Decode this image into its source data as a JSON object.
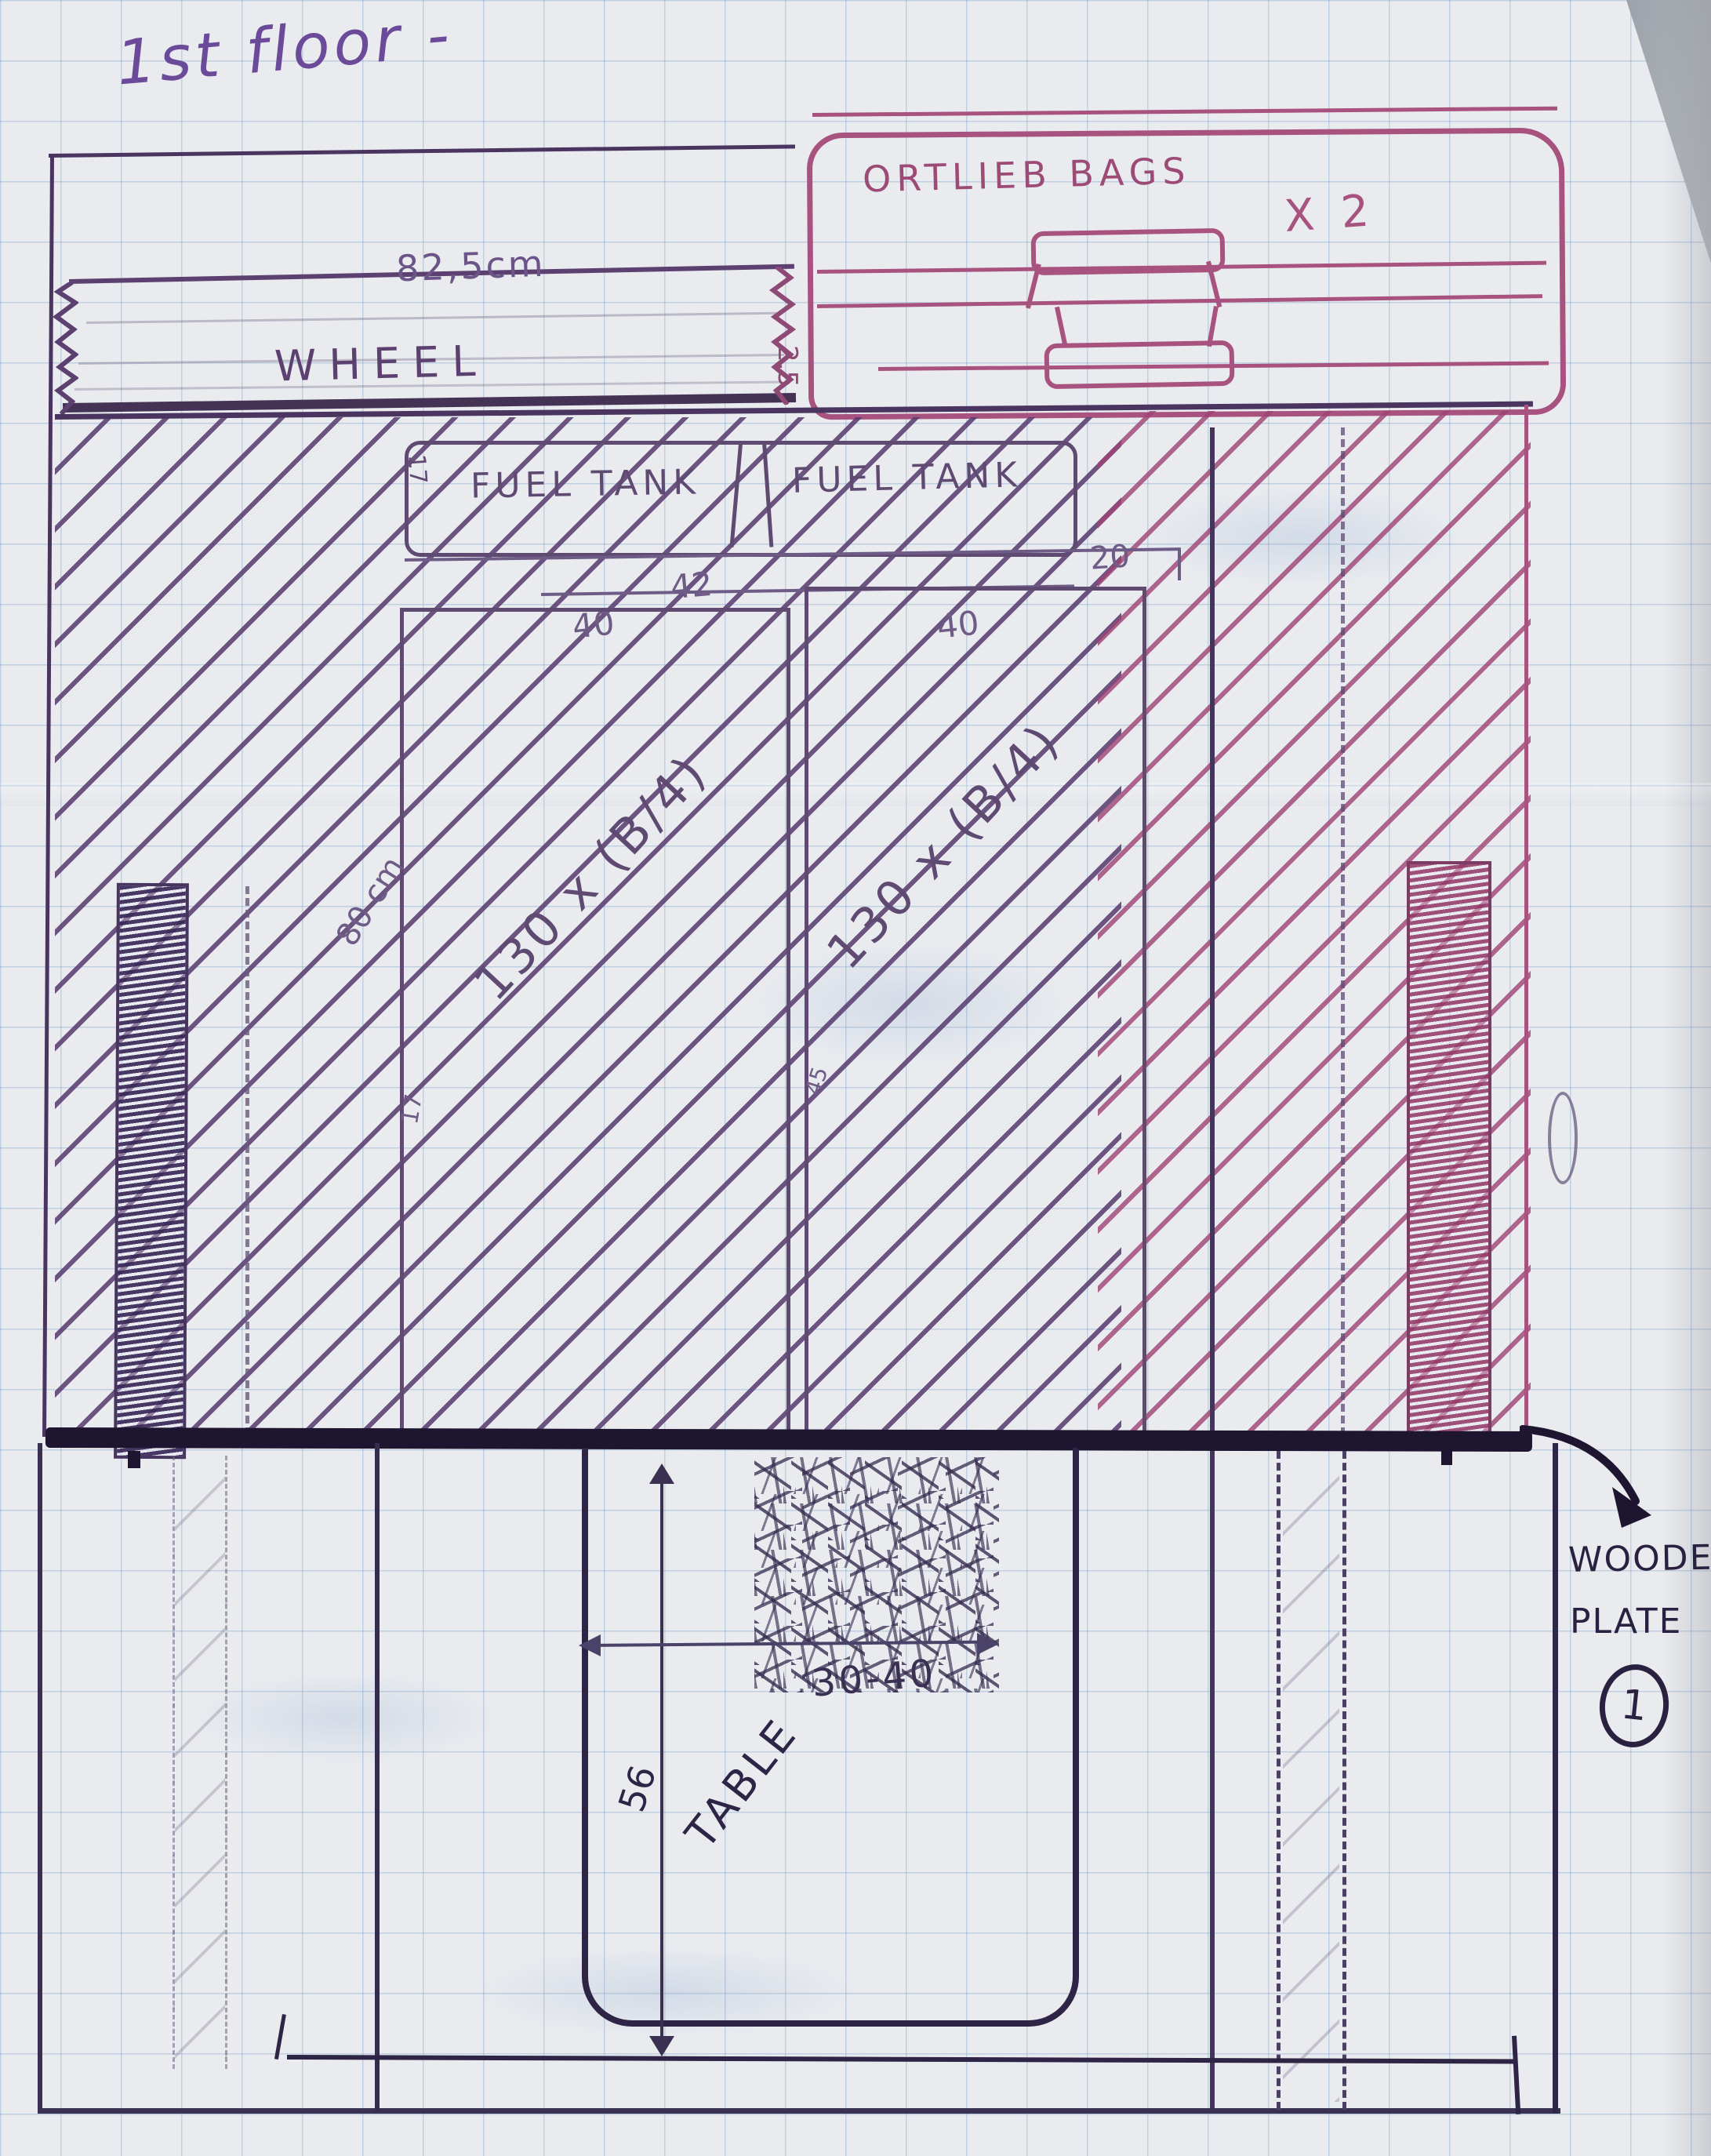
{
  "title": "1st floor -",
  "wheel": {
    "dim": "82,5cm",
    "label": "WHEEL",
    "side_dim": "2,5"
  },
  "bags": {
    "label": "ORTLIEB BAGS",
    "qty": "X 2"
  },
  "fuel": {
    "label_left": "FUEL TANK",
    "label_right": "FUEL TANK",
    "side": "17"
  },
  "dims": {
    "d42": "42",
    "d40_left": "40",
    "d40_right": "40",
    "d20": "20",
    "d80": "80 cm",
    "d17_small": "17",
    "d45_small": "45"
  },
  "beds": {
    "left_label": "130 x (B/4)",
    "right_label": "130 x (B/4)"
  },
  "table": {
    "label": "TABLE",
    "width_dim": "30-40",
    "height_dim": "56"
  },
  "plate": {
    "line1": "WOODEN",
    "line2": "PLATE",
    "number": "1"
  },
  "colors": {
    "ink_purple": "#5c4170",
    "ink_pink": "#a8537f",
    "pencil_dark": "#2e2546",
    "heavy_line": "#1e1630"
  }
}
